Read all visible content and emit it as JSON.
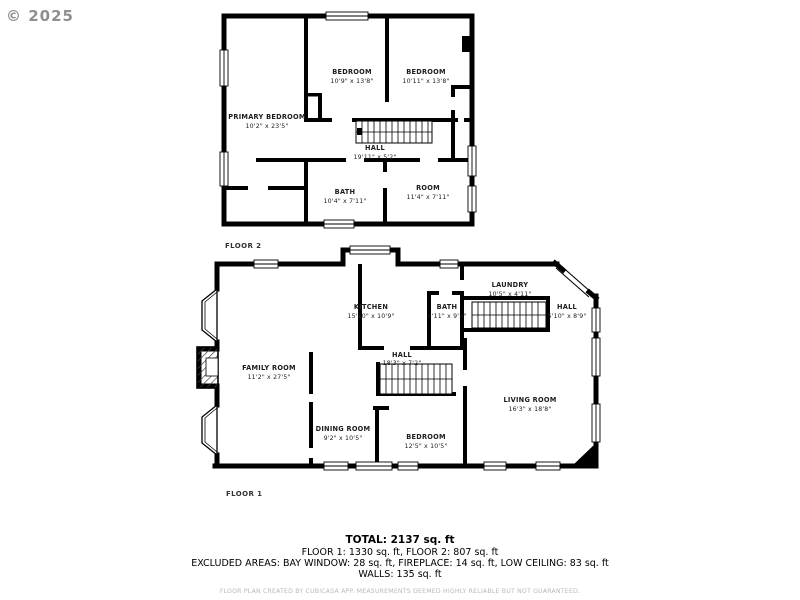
{
  "watermark": "© 2025",
  "floor2": {
    "label": "FLOOR 2",
    "primary": {
      "name": "PRIMARY BEDROOM",
      "dims": "10'2\" x 23'5\""
    },
    "bedroom1": {
      "name": "BEDROOM",
      "dims": "10'9\" x 13'8\""
    },
    "bedroom2": {
      "name": "BEDROOM",
      "dims": "10'11\" x 13'8\""
    },
    "hall": {
      "name": "HALL",
      "dims": "19'11\" x 5'2\""
    },
    "bath": {
      "name": "BATH",
      "dims": "10'4\" x 7'11\""
    },
    "room": {
      "name": "ROOM",
      "dims": "11'4\" x 7'11\""
    }
  },
  "floor1": {
    "label": "FLOOR 1",
    "family": {
      "name": "FAMILY ROOM",
      "dims": "11'2\" x 27'5\""
    },
    "kitchen": {
      "name": "KITCHEN",
      "dims": "15'10\" x 10'9\""
    },
    "bath": {
      "name": "BATH",
      "dims": "4'11\" x 9'2\""
    },
    "laundry": {
      "name": "LAUNDRY",
      "dims": "10'5\" x 4'11\""
    },
    "hall_small": {
      "name": "HALL",
      "dims": "5'10\" x 8'9\""
    },
    "hall_main": {
      "name": "HALL",
      "dims": "18'3\" x 7'2\""
    },
    "dining": {
      "name": "DINING ROOM",
      "dims": "9'2\" x 10'5\""
    },
    "bedroom": {
      "name": "BEDROOM",
      "dims": "12'5\" x 10'5\""
    },
    "living": {
      "name": "LIVING ROOM",
      "dims": "16'3\" x 18'8\""
    }
  },
  "summary": {
    "total": "TOTAL: 2137 sq. ft",
    "floors": "FLOOR 1: 1330 sq. ft, FLOOR 2: 807 sq. ft",
    "excluded": "EXCLUDED AREAS: BAY WINDOW: 28 sq. ft, FIREPLACE: 14 sq. ft, LOW CEILING: 83 sq. ft",
    "walls": "WALLS: 135 sq. ft",
    "disclaimer": "FLOOR PLAN CREATED BY CUBICASA APP. MEASUREMENTS DEEMED HIGHLY RELIABLE BUT NOT GUARANTEED."
  }
}
